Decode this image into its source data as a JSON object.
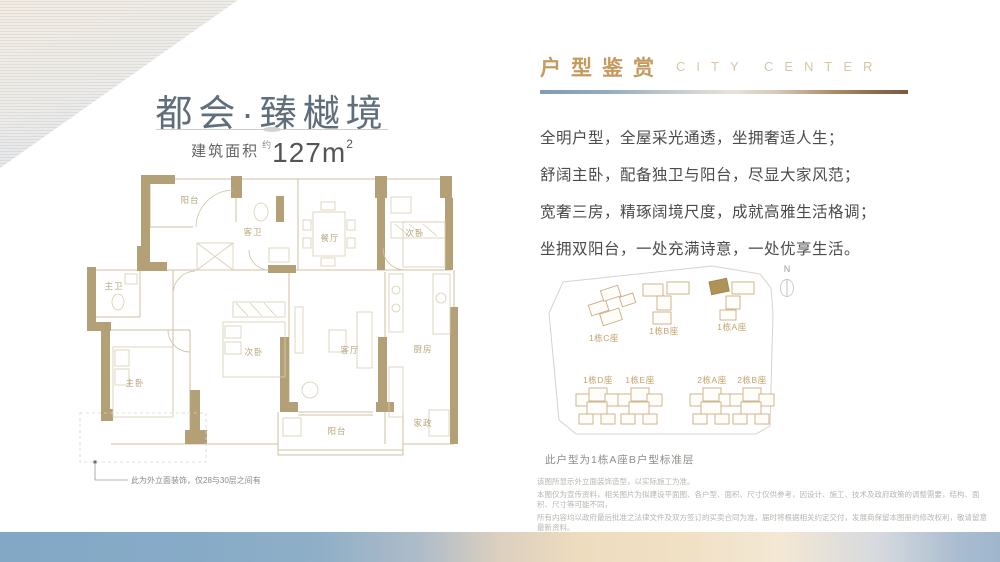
{
  "header": {
    "project_title": "都会·臻樾境",
    "area_label": "建筑面积",
    "area_approx_mark": "约",
    "area_value": "127m",
    "area_superscript": "2"
  },
  "floorplan": {
    "rooms": [
      "阳台",
      "客卫",
      "餐厅",
      "次卧",
      "主卫",
      "次卧",
      "客厅",
      "厨房",
      "主卧",
      "阳台",
      "家政"
    ],
    "note": "此为外立面装饰，仅28与30层之间有"
  },
  "right_panel": {
    "section_title_cn": "户型鉴赏",
    "section_title_en": "CITY CENTER",
    "paragraphs": [
      "全明户型，全屋采光通透，坐拥奢适人生；",
      "舒阔主卧，配备独卫与阳台，尽显大家风范；",
      "宽奢三房，精琢阔境尺度，成就高雅生活格调；",
      "坐拥双阳台，一处充满诗意，一处优享生活。"
    ],
    "siteplan": {
      "north_label": "N",
      "building_labels": [
        "1栋C座",
        "1栋B座",
        "1栋A座",
        "1栋D座",
        "1栋E座",
        "2栋A座",
        "2栋B座"
      ],
      "caption": "此户型为1栋A座B户型标准层"
    },
    "disclaimer": [
      "该图所显示外立面装饰造型，以实际施工为准。",
      "本图仅为宣传资料，相关图片为拟建设平面图、各户型、面积、尺寸仅供参考，因设计、施工、技术及政府政策的调整需要，结构、面积、尺寸等可能不同，",
      "所有内容均以政府最后批准之法律文件及双方签订的买卖合同为准，届时将根据相关约定交付，发展商保留本图册的修改权利，敬请留意最新资料。"
    ]
  },
  "colors": {
    "title_blue_gray": "#5f6e7b",
    "gold": "#c49a5f",
    "gold_light": "#d9c6a6",
    "wall_tan": "#b3a077",
    "plan_line": "#cfc2a3",
    "body_text": "#4b4b4b",
    "footer_blue": "#84a9c6",
    "footer_peach": "#eedbbf",
    "highlight_building": "#ae9256"
  }
}
